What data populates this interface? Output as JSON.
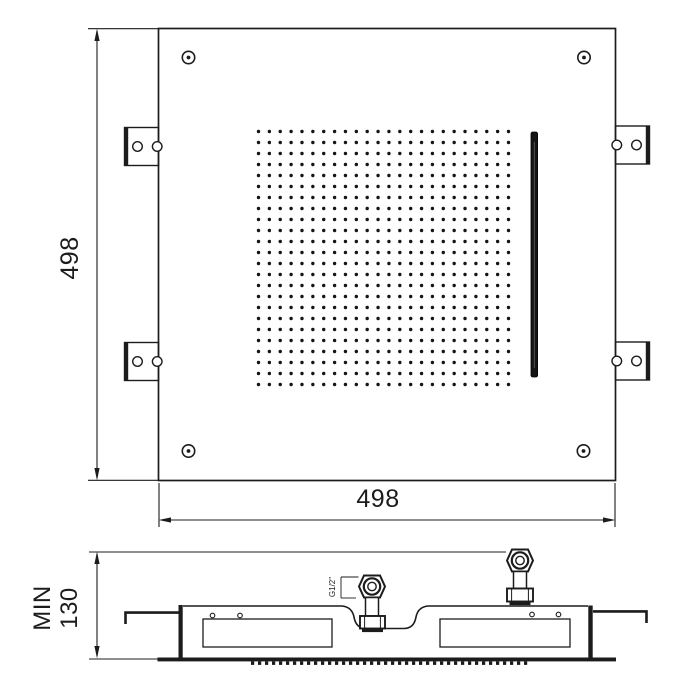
{
  "drawing": {
    "kind": "technical-drawing",
    "colors": {
      "line": "#1c1c1c",
      "background": "#ffffff",
      "slot_fill": "#141414"
    },
    "plan_view": {
      "dimension_height": {
        "value": "498"
      },
      "dimension_width": {
        "value": "498"
      },
      "nozzle_grid": {
        "rows": 24,
        "cols": 24,
        "x0": 258.5,
        "y0": 131.5,
        "dx": 10.87,
        "dy": 11.0,
        "r": 1.7
      },
      "corner_screws": 4,
      "mounting_brackets": 4
    },
    "side_view": {
      "dimension_depth": {
        "prefix": "MIN",
        "value": "130",
        "combined": "MIN\n130"
      },
      "inlet_thread": {
        "label": "G1/2\""
      },
      "spray_teeth": {
        "x_start": 251,
        "x_end": 526,
        "pitch": 7,
        "width": 3.2,
        "height": 3.4,
        "y": 661.5
      }
    }
  }
}
